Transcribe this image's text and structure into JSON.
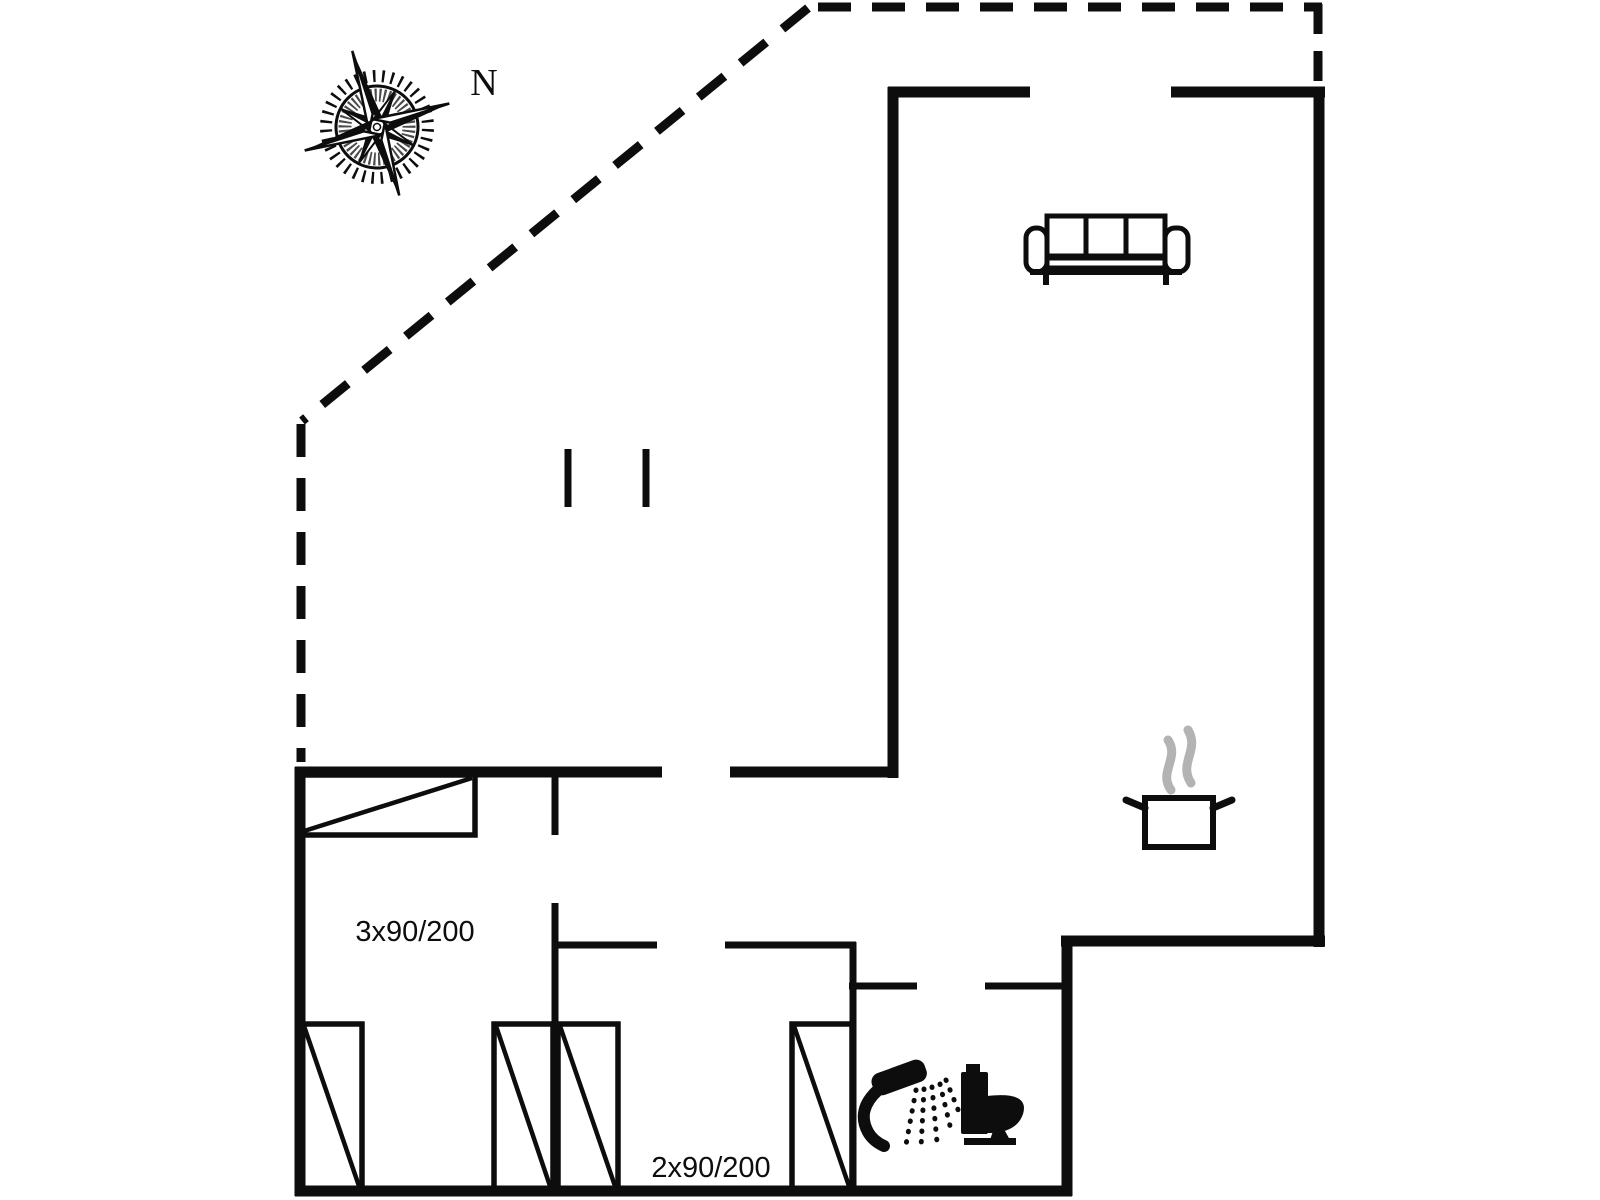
{
  "labels": {
    "north": "N",
    "bedroom1_bed_size": "3x90/200",
    "bedroom2_bed_size": "2x90/200"
  },
  "colors": {
    "line": "#0d0d0d",
    "steam": "#b3b3b3",
    "background": "#ffffff"
  },
  "icons": {
    "compass": "compass-rose-icon",
    "sofa": "sofa-icon",
    "cooking_pot": "cooking-pot-icon",
    "steam": "steam-icon",
    "shower": "shower-icon",
    "toilet": "toilet-icon",
    "bed": "bed-icon",
    "bed_count": 5
  }
}
